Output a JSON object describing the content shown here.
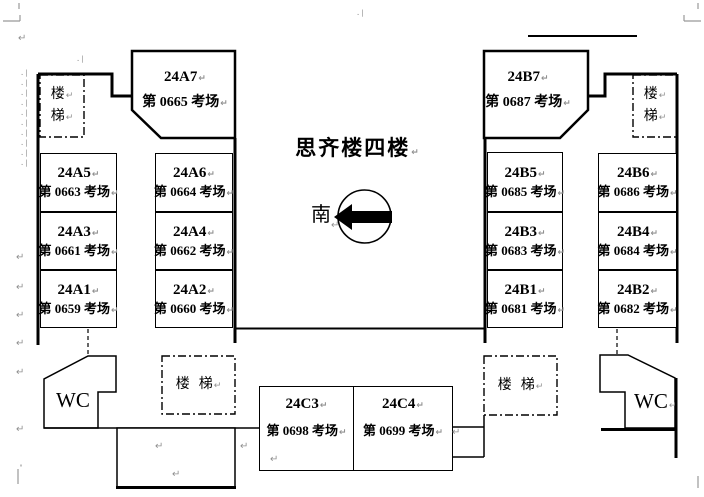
{
  "document": {
    "page_title": "思齐楼四楼",
    "compass_label": "南",
    "wc_label": "WC",
    "stairs": {
      "upper": "楼",
      "lower": "梯"
    },
    "glyphs": {
      "pilcrow": "↵",
      "paragraph_dots": ".|"
    },
    "colors": {
      "ink": "#000000",
      "mark_grey": "#909090"
    }
  },
  "rooms": {
    "a7": {
      "code": "24A7",
      "venue": "第 0665 考场"
    },
    "a5": {
      "code": "24A5",
      "venue": "第 0663 考场"
    },
    "a6": {
      "code": "24A6",
      "venue": "第 0664 考场"
    },
    "a3": {
      "code": "24A3",
      "venue": "第 0661 考场"
    },
    "a4": {
      "code": "24A4",
      "venue": "第 0662 考场"
    },
    "a1": {
      "code": "24A1",
      "venue": "第 0659 考场"
    },
    "a2": {
      "code": "24A2",
      "venue": "第 0660 考场"
    },
    "b7": {
      "code": "24B7",
      "venue": "第 0687 考场"
    },
    "b5": {
      "code": "24B5",
      "venue": "第 0685 考场"
    },
    "b6": {
      "code": "24B6",
      "venue": "第 0686 考场"
    },
    "b3": {
      "code": "24B3",
      "venue": "第 0683 考场"
    },
    "b4": {
      "code": "24B4",
      "venue": "第 0684 考场"
    },
    "b1": {
      "code": "24B1",
      "venue": "第 0681 考场"
    },
    "b2": {
      "code": "24B2",
      "venue": "第 0682 考场"
    },
    "c3": {
      "code": "24C3",
      "venue": "第 0698 考场"
    },
    "c4": {
      "code": "24C4",
      "venue": "第 0699 考场"
    }
  }
}
